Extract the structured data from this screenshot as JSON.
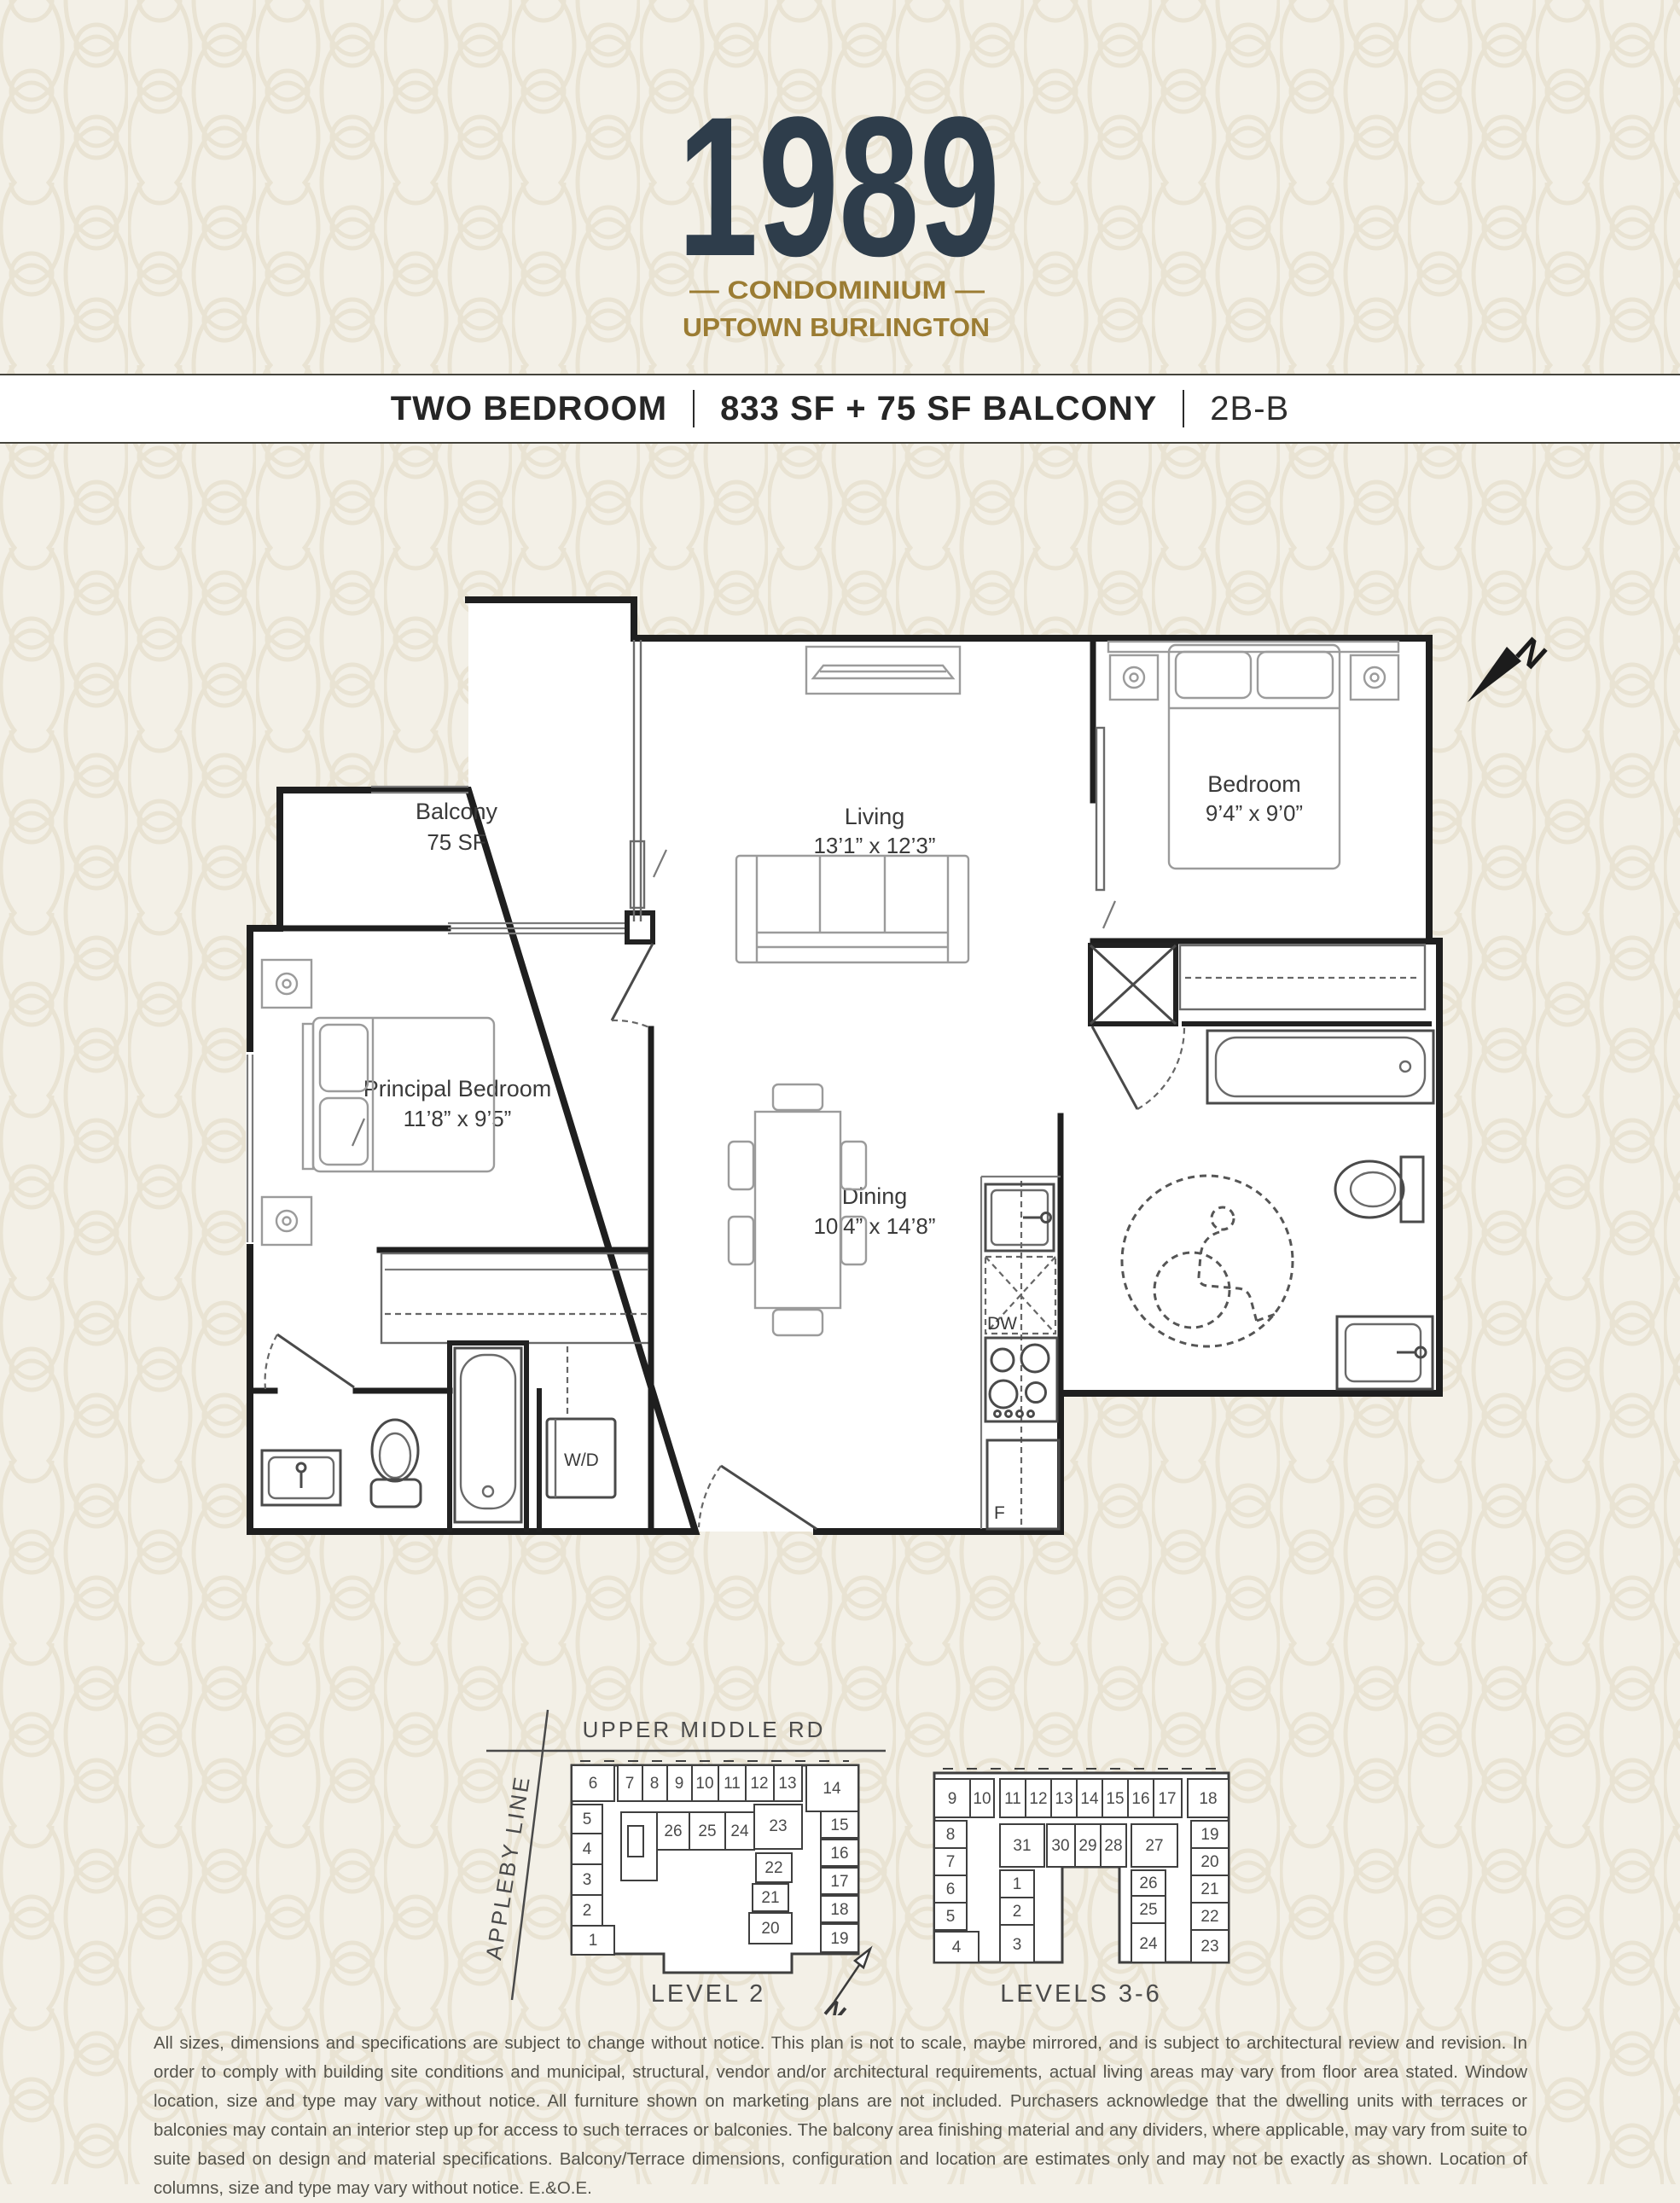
{
  "header": {
    "year": "1989",
    "line1": "— CONDOMINIUM —",
    "line2": "UPTOWN BURLINGTON"
  },
  "title_bar": {
    "unit_type": "TWO BEDROOM",
    "area": "833 SF + 75 SF BALCONY",
    "unit_code": "2B-B"
  },
  "plan": {
    "rooms": {
      "balcony": {
        "name": "Balcony",
        "dims": "75 SF"
      },
      "living": {
        "name": "Living",
        "dims": "13’1” x 12’3”"
      },
      "bedroom": {
        "name": "Bedroom",
        "dims": "9’4” x 9’0”"
      },
      "principal": {
        "name": "Principal Bedroom",
        "dims": "11’8” x 9’5”"
      },
      "dining": {
        "name": "Dining",
        "dims": "10’4” x 14’8”"
      }
    },
    "appliances": {
      "washer_dryer": "W/D",
      "dishwasher": "DW",
      "fridge": "F"
    },
    "north_label": "N"
  },
  "key_plans": {
    "level2": {
      "title": "LEVEL 2",
      "street": "UPPER MIDDLE RD",
      "cross_street": "APPLEBY LINE",
      "highlighted_unit": "23",
      "units": [
        "6",
        "7",
        "8",
        "9",
        "10",
        "11",
        "12",
        "13",
        "14",
        "5",
        "4",
        "3",
        "2",
        "1",
        "26",
        "25",
        "24",
        "23",
        "15",
        "16",
        "17",
        "18",
        "19",
        "22",
        "21",
        "20"
      ]
    },
    "levels36": {
      "title": "LEVELS 3-6",
      "highlighted_units": "31, 27",
      "units": [
        "9",
        "10",
        "11",
        "12",
        "13",
        "14",
        "15",
        "16",
        "17",
        "18",
        "8",
        "7",
        "6",
        "5",
        "4",
        "31",
        "30",
        "29",
        "28",
        "27",
        "1",
        "2",
        "3",
        "26",
        "25",
        "24",
        "19",
        "20",
        "21",
        "22",
        "23"
      ]
    },
    "north_label": "N"
  },
  "disclaimer": "All sizes, dimensions and specifications are subject to change without notice. This plan is not to scale, maybe mirrored, and is subject to architectural review and revision. In order to comply with building site conditions and municipal, structural, vendor and/or architectural requirements, actual living areas may vary from floor area stated. Window location, size and type may vary without notice. All furniture shown on marketing plans are not included. Purchasers acknowledge that the dwelling units with terraces or balconies may contain an interior step up for access to such terraces or balconies. The balcony area finishing material and any dividers, where applicable, may vary from suite to suite based on design and material specifications. Balcony/Terrace dimensions, configuration and location are estimates only and may not be exactly as shown. Location of columns, size and type may vary without notice. E.&O.E.",
  "colors": {
    "navy": "#2e3d4b",
    "gold": "#9b7c33",
    "highlight": "#d9cfbd",
    "wall": "#1f1f1f",
    "background": "#f3f0e7"
  }
}
